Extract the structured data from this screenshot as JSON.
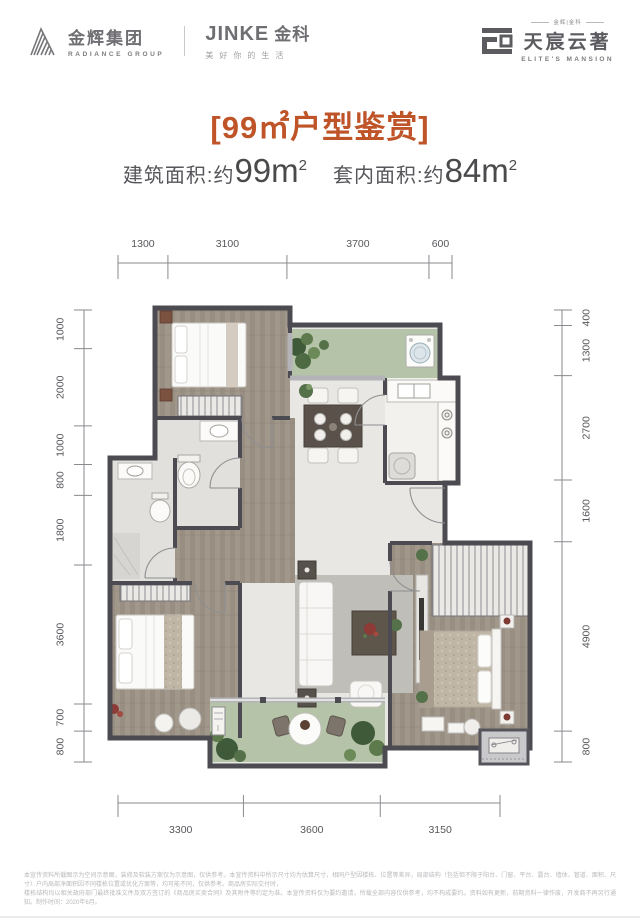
{
  "header": {
    "radiance": {
      "cn": "金辉集团",
      "en": "RADIANCE GROUP",
      "icon": "radiance-mountain-icon"
    },
    "jinke": {
      "brand": "JINKE",
      "cn": "金科",
      "tagline": "美好你的生活"
    },
    "mansion": {
      "small": "金辉|金科",
      "cn": "天宸云著",
      "en": "ELITE'S MANSION",
      "icon": "mansion-cloud-icon"
    }
  },
  "title": "[99㎡户型鉴赏]",
  "areas": {
    "built_label": "建筑面积:约",
    "built_value": "99m",
    "built_sup": "2",
    "inner_label": "套内面积:约",
    "inner_value": "84m",
    "inner_sup": "2"
  },
  "dimensions": {
    "top": [
      1300,
      3100,
      3700,
      600
    ],
    "bottom": [
      3300,
      3600,
      3150
    ],
    "left": [
      1000,
      2000,
      1000,
      800,
      1800,
      3600,
      700,
      800
    ],
    "right": [
      400,
      1300,
      2700,
      1600,
      4900,
      800
    ]
  },
  "colors": {
    "accent_orange": "#bf5429",
    "wall_dark": "#4c4b51",
    "wall_light": "#b4b3b7",
    "floor_wood": "#a2978b",
    "floor_marble": "#e8e7e3",
    "balcony_green": "#b5c3a8",
    "text_dark": "#4f4f52",
    "dim_text": "#57565a"
  },
  "disclaimer": {
    "line1": "本宣传资料所载图示为空间示意图，装修及软装方案仅为示意图，仅供参考。本宣传资料中所示尺寸均为估算尺寸，相同户型因楼栋、位置等差异，局部结构（包括但不限于阳台、门窗、平台、露台、墙体、管道、面积、尺寸）户内局部净面积因不同楼栋位置或优化方案等，均可能不同，仅供参考。商品房实际交付时，",
    "line2": "楼栋结构均以相关政府部门最终批准文件及双方签订的《商品房买卖合同》及其附件等约定为准。本宣传资料仅为要约邀请，所载全部内容仅供参考，均不构成要约。资料如有更新，前期资料一律作废，开发商不再另行通知。制作时间：2020年6月。"
  }
}
